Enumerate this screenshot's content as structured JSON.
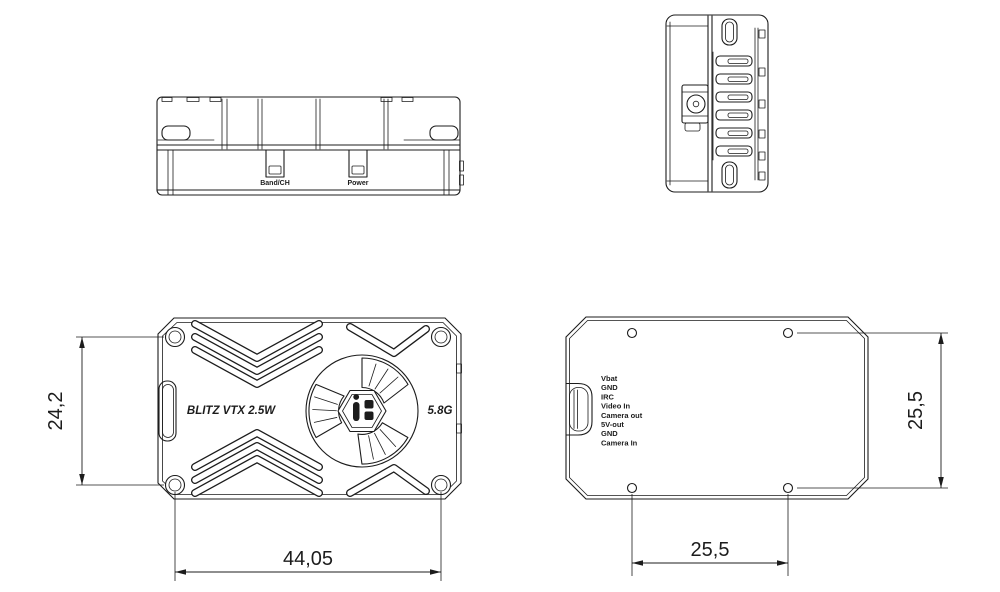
{
  "colors": {
    "line": "#1c1c1c",
    "background": "#ffffff"
  },
  "views": {
    "front": {
      "band_ch_label": "Band/CH",
      "power_label": "Power"
    },
    "side": {
      "connector_icon": "ufl-antenna-connector"
    },
    "top": {
      "product_label": "BLITZ VTX 2.5W",
      "band_label": "5.8G",
      "logo_icon": "iflight-logo"
    },
    "bottom": {
      "pins": [
        "Vbat",
        "GND",
        "IRC",
        "Video In",
        "Camera out",
        "5V-out",
        "GND",
        "Camera In"
      ]
    }
  },
  "dimensions": {
    "body_height": "24,2",
    "body_width": "44,05",
    "hole_spacing_vertical": "25,5",
    "hole_spacing_horizontal": "25,5"
  }
}
